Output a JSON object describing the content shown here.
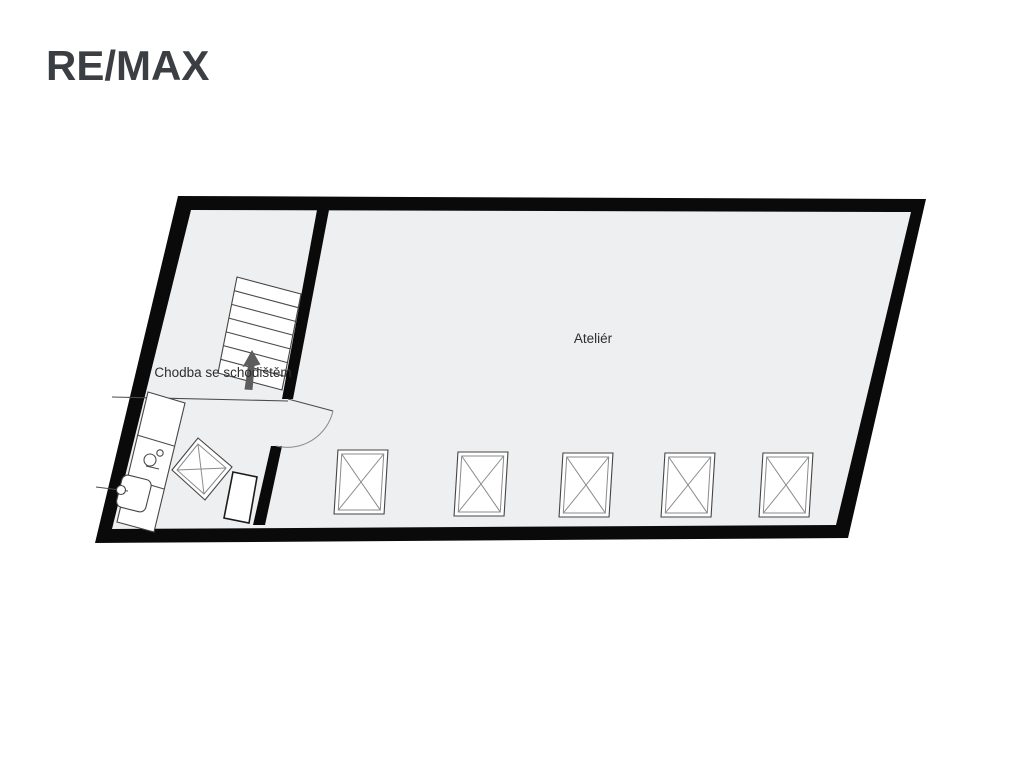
{
  "brand": {
    "logo_text": "RE/MAX"
  },
  "floor_plan": {
    "room_labels": {
      "hallway": "Chodba se schodištěm",
      "atelier": "Ateliér"
    },
    "colors": {
      "wall": "#0a0a0a",
      "floor": "#eeeff0",
      "fixture_fill": "#ffffff",
      "stair_arrow": "#5d5d5d"
    },
    "features": {
      "atelier_skylights": 5,
      "hallway_skylights": 1,
      "stair_treads": 7,
      "doors": 1
    }
  }
}
